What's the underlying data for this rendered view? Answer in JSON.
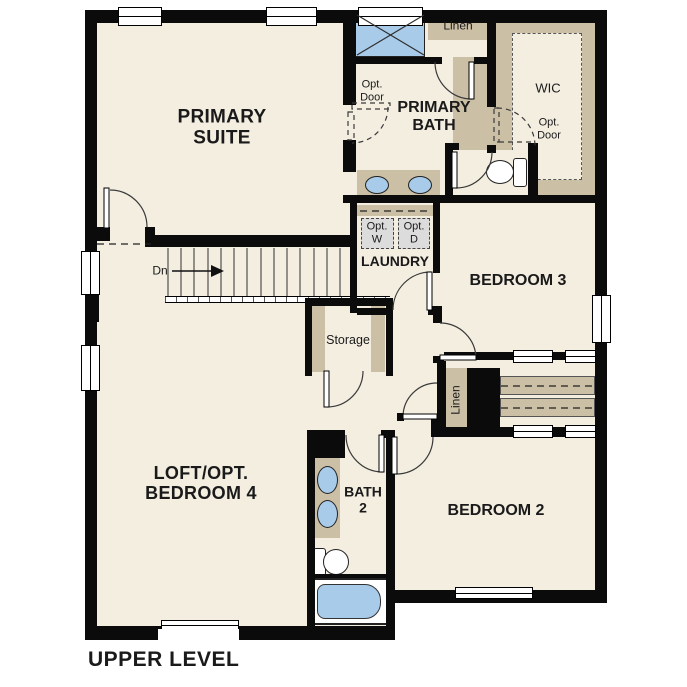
{
  "title": "UPPER LEVEL",
  "colors": {
    "floor": "#f4eee1",
    "cabinet_tan": "#cbbfa5",
    "fixture_blue": "#a9cbea",
    "wall_black": "#0b0b0b",
    "appliance_gray": "#dcdcdc"
  },
  "rooms": {
    "primary_suite": "PRIMARY SUITE",
    "primary_bath": "PRIMARY BATH",
    "wic": "WIC",
    "laundry": "LAUNDRY",
    "bedroom3": "BEDROOM 3",
    "bedroom2": "BEDROOM 2",
    "loft": "LOFT/OPT. BEDROOM 4",
    "bath2": "BATH 2"
  },
  "labels": {
    "linen_top": "Linen",
    "linen_mid": "Linen",
    "storage": "Storage",
    "opt_door_bath": "Opt. Door",
    "opt_door_wic": "Opt. Door",
    "opt_washer": "Opt. W",
    "opt_dryer": "Opt. D",
    "stairs_down": "Dn"
  }
}
